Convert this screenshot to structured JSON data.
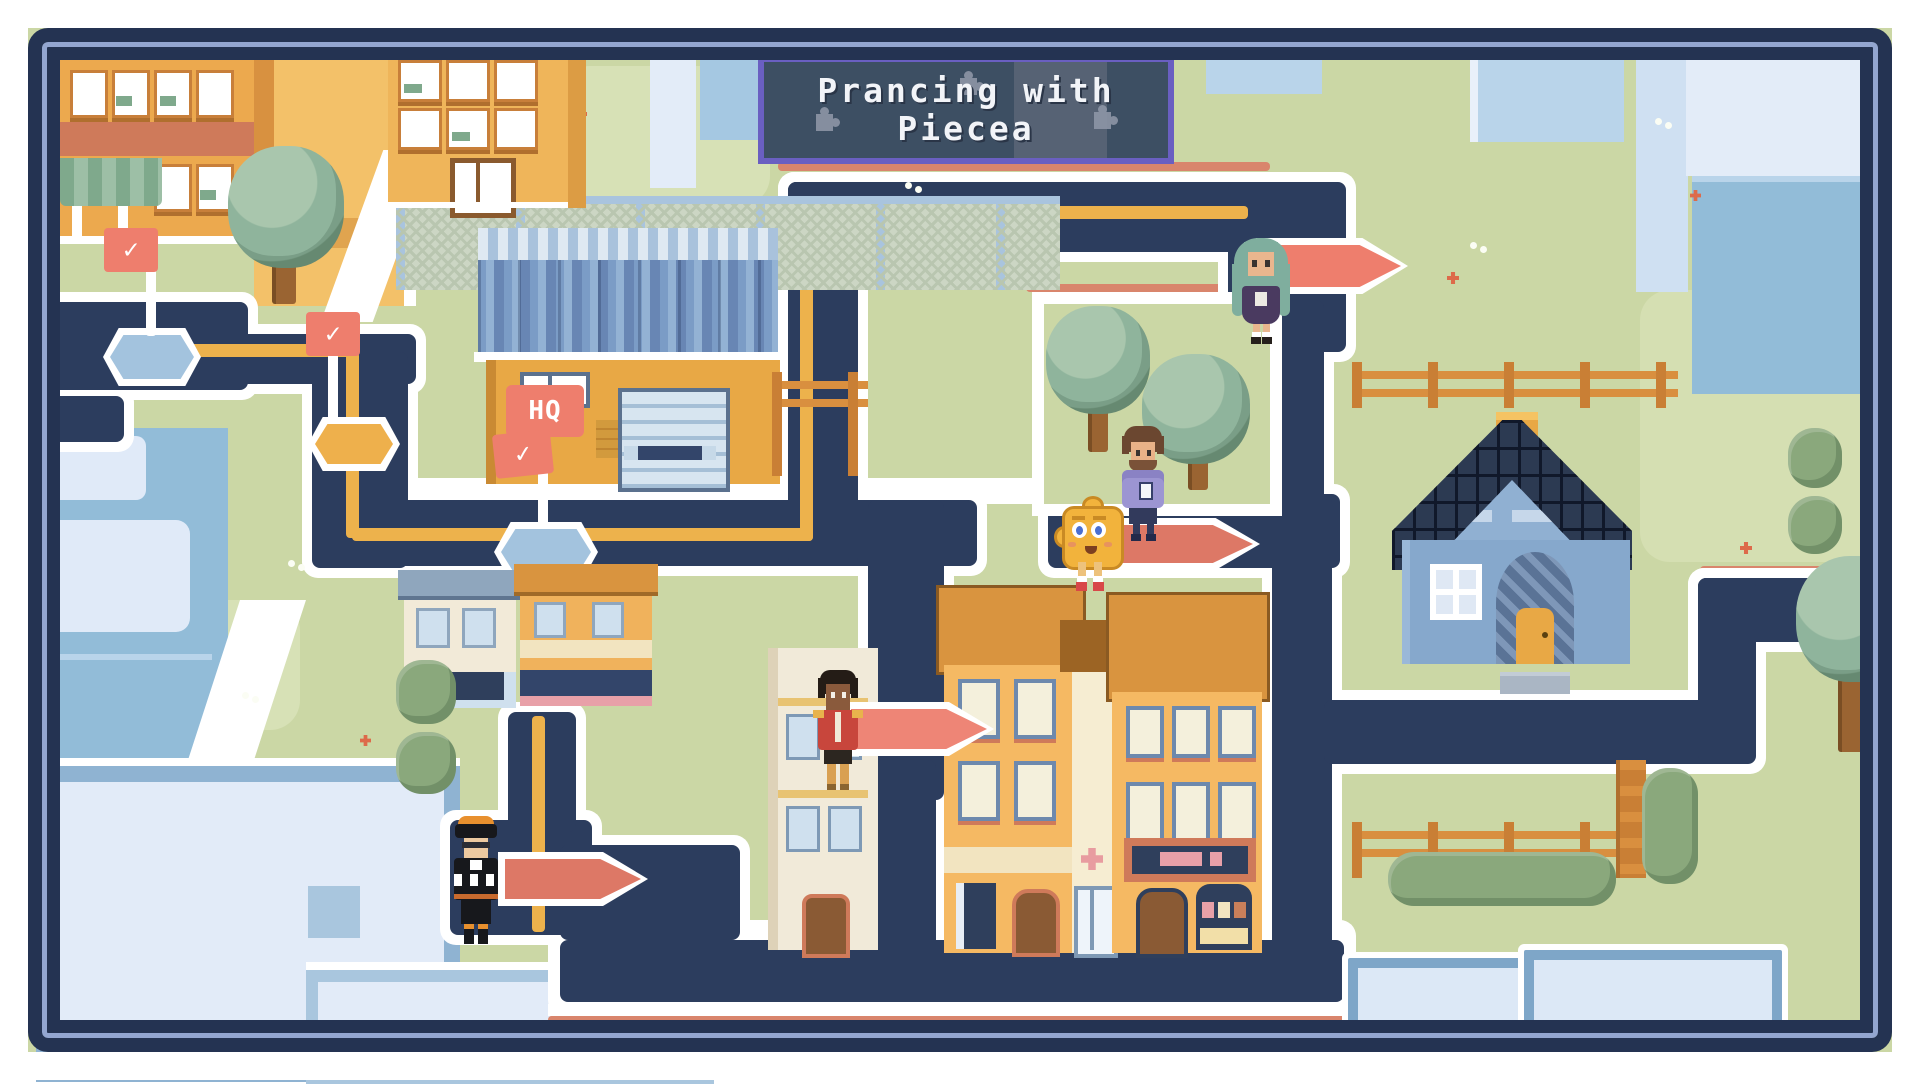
{
  "game": {
    "title_line1": "Prancing with",
    "title_line2": "Piecea",
    "checkmark_glyph": "✓"
  },
  "hq": {
    "label": "HQ"
  },
  "markers": {
    "completed_checkpoint_flags": 3,
    "active_arrow_markers": 4,
    "nodes": [
      {
        "id": "node-left",
        "state": "completed",
        "color": "#a3c3de"
      },
      {
        "id": "node-yellow",
        "state": "current",
        "color": "#eeb04c"
      },
      {
        "id": "node-hq",
        "state": "completed",
        "color": "#a3c3de"
      }
    ],
    "arrow_color": "#ee7e6d",
    "path_line_color": "#edb24c"
  },
  "characters": [
    {
      "id": "green-hair-girl",
      "desc": "long teal-green hair, dark purple dress",
      "location": "top-right road junction"
    },
    {
      "id": "purple-hoodie-man",
      "desc": "brown hair, beard, lavender hoodie, holding phone",
      "location": "park edge"
    },
    {
      "id": "piecea-mascot",
      "desc": "yellow puzzle-piece blob with face, red shoes",
      "location": "center-right road"
    },
    {
      "id": "red-jacket-hero",
      "desc": "dark skin, red jacket with gold epaulettes, tan boots",
      "location": "central vertical road"
    },
    {
      "id": "black-suit-racer",
      "desc": "orange hair, black suit with white checker band",
      "location": "bottom-left junction"
    }
  ],
  "buildings": [
    {
      "id": "warehouse-hq",
      "desc": "orange warehouse, blue corrugated roof, chain-link fence"
    },
    {
      "id": "apartment-top-left",
      "desc": "orange apartment with green awning"
    },
    {
      "id": "apartment-top-mid",
      "desc": "yellow apartment with white double doors"
    },
    {
      "id": "blue-house",
      "desc": "blue house with dark shingle roof and chimney"
    },
    {
      "id": "townhouses",
      "desc": "tall orange townhouses with storefronts and pharmacy cross"
    }
  ],
  "colors": {
    "grass": "#cbd7a5",
    "road": "#2c3d5e",
    "road_outline": "#ffffff",
    "accent_salmon": "#d9856c",
    "banner_bg": "#3d4f63",
    "banner_border": "#6a5fc1",
    "flag_red": "#ee7e6d",
    "building_orange": "#eca94e",
    "roof_navy": "#2c3a52",
    "rooftop_blue": "#92bcd8"
  }
}
